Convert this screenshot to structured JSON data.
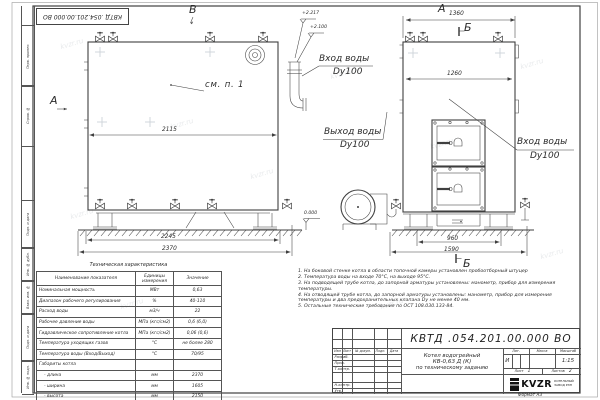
{
  "doc": {
    "number": "КВТД .054.201.00.000  ВО",
    "format_label": "Формат  А3"
  },
  "watermark": "kvzr.ru",
  "frame_strip": {
    "labels": [
      "Перв. примен.",
      "Справ. №",
      "Подп. и дата",
      "Инв. № дубл.",
      "Взам. инв. №",
      "Подп. и дата",
      "Инв. № подл."
    ]
  },
  "views": {
    "side": {
      "view_letter_b": "В",
      "view_letter_a": "А",
      "see_item": "см. п. 1",
      "elev_top": "+2.217",
      "elev_mid": "+2.100",
      "elev_zero": "0.000",
      "dim_inner": "2115",
      "dim_base": "2245",
      "dim_overall": "2370",
      "water_inlet_line1": "Вход воды",
      "water_inlet_line2": "Dy100",
      "water_outlet_line1": "Выход воды",
      "water_outlet_line2": "Dy100"
    },
    "front": {
      "view_letter": "А",
      "section_letter_top": "Б",
      "section_letter_bottom": "Б",
      "dim_top": "1360",
      "dim_inner": "1260",
      "dim_base": "960",
      "dim_overall": "1590",
      "water_inlet_line1": "Вход воды",
      "water_inlet_line2": "Dy100"
    }
  },
  "spec_table": {
    "title": "Техническая характеристика",
    "headers": [
      "Наименование показателя",
      "Единицы измерения",
      "Значение"
    ],
    "rows": [
      [
        "Номинальная мощность",
        "МВт",
        "0,63"
      ],
      [
        "Диапазон рабочего регулирования",
        "%",
        "40-110"
      ],
      [
        "Расход воды",
        "м3/ч",
        "22"
      ],
      [
        "Рабочее давление воды",
        "МПа (кгс/см2)",
        "0,6 (6,0)"
      ],
      [
        "Гидравлическое сопротивление котла",
        "МПа (кгс/см2)",
        "0,06 (0,6)"
      ],
      [
        "Температура уходящих газов",
        "°С",
        "не более 280"
      ],
      [
        "Температура воды (Вход/Выход)",
        "°С",
        "70/95"
      ],
      [
        "Габариты котла",
        "",
        ""
      ],
      [
        "- длина",
        "мм",
        "2370"
      ],
      [
        "- ширина",
        "мм",
        "1605"
      ],
      [
        "- высота",
        "мм",
        "2150"
      ]
    ]
  },
  "notes": {
    "items": [
      "1.  На боковой стенке котла в области топочной камеры установлен пробоотборный штуцер",
      "2.  Температура воды на входе 70°С, на выходе 95°С.",
      "3.  На подводящей трубе котла, до запорной арматуры установлены: манометр, прибор для измерения температуры.",
      "4.  На отводящей трубе котла, до запорной арматуры установлены: манометр, прибор для измерения температуры и два предохранительных клапана Dу не менее 40 мм.",
      "5.  Остальные технические требования по ОСТ 108.030.133-84."
    ]
  },
  "title_block": {
    "rev_header": [
      "Изм",
      "Лист",
      "№ докум.",
      "Подп.",
      "Дата"
    ],
    "sign_labels": [
      "Разраб.",
      "Пров.",
      "Т.контр.",
      "Н.контр.",
      "Утв."
    ],
    "title_lines": [
      "Котел водогрейный",
      "КВ-0,63 Д (К)",
      "по техническому заданию"
    ],
    "lit_label": "Лит.",
    "lit_value": "И",
    "mass_label": "Масса",
    "scale_label": "Масштаб",
    "scale_value": "1:15",
    "sheet_label": "Лист",
    "sheet_value": "1",
    "sheets_label": "Листов",
    "sheets_value": "2",
    "logo_text": "KVZR",
    "company_line1": "КОТЕЛЬНЫЙ",
    "company_line2": "ЗАВОД РЭП"
  }
}
